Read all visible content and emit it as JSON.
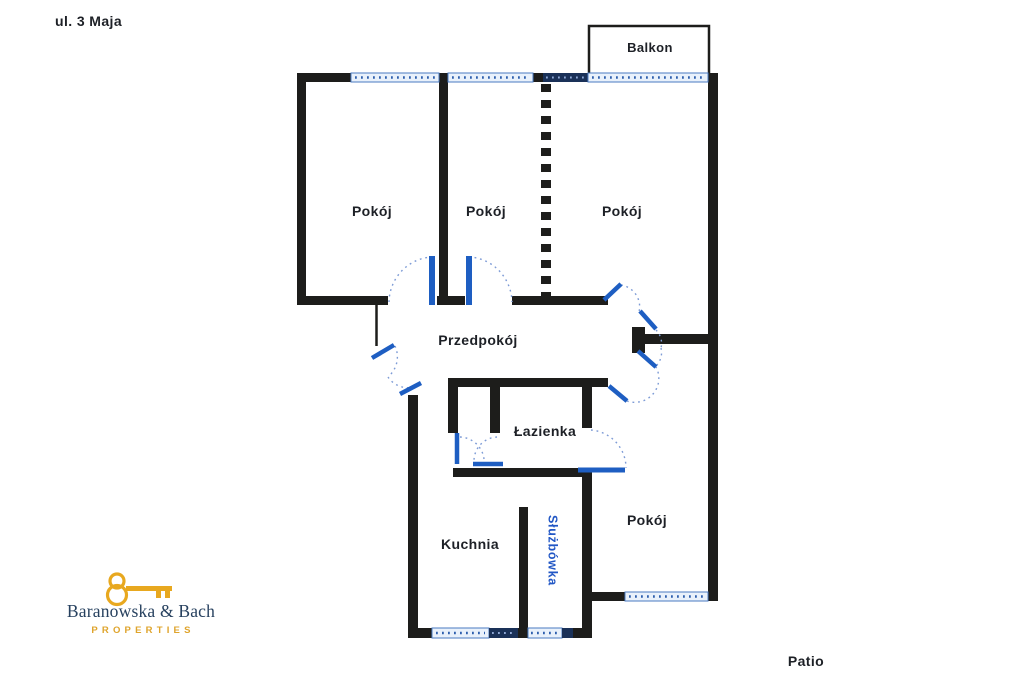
{
  "plan": {
    "street_label": "ul. 3 Maja",
    "patio_label": "Patio",
    "rooms": {
      "balcony": "Balkon",
      "room_nw": "Pokój",
      "room_mid": "Pokój",
      "room_ne": "Pokój",
      "hallway": "Przedpokój",
      "bathroom": "Łazienka",
      "kitchen": "Kuchnia",
      "maids_room": "Służbówka",
      "room_se": "Pokój"
    },
    "colors": {
      "wall": "#1d1d1b",
      "door_blue": "#1e5ec2",
      "window_light_fill": "#e9f1fb",
      "window_frame": "#4a7ac2",
      "window_dark_fill": "#1a3158",
      "arc_dotted": "#7d9bd6",
      "label_text": "#1d2026",
      "maids_room_text": "#2257c5"
    }
  },
  "logo": {
    "name": "Baranowska & Bach",
    "tagline": "PROPERTIES",
    "navy": "#27415f",
    "gold": "#e8a81f"
  }
}
